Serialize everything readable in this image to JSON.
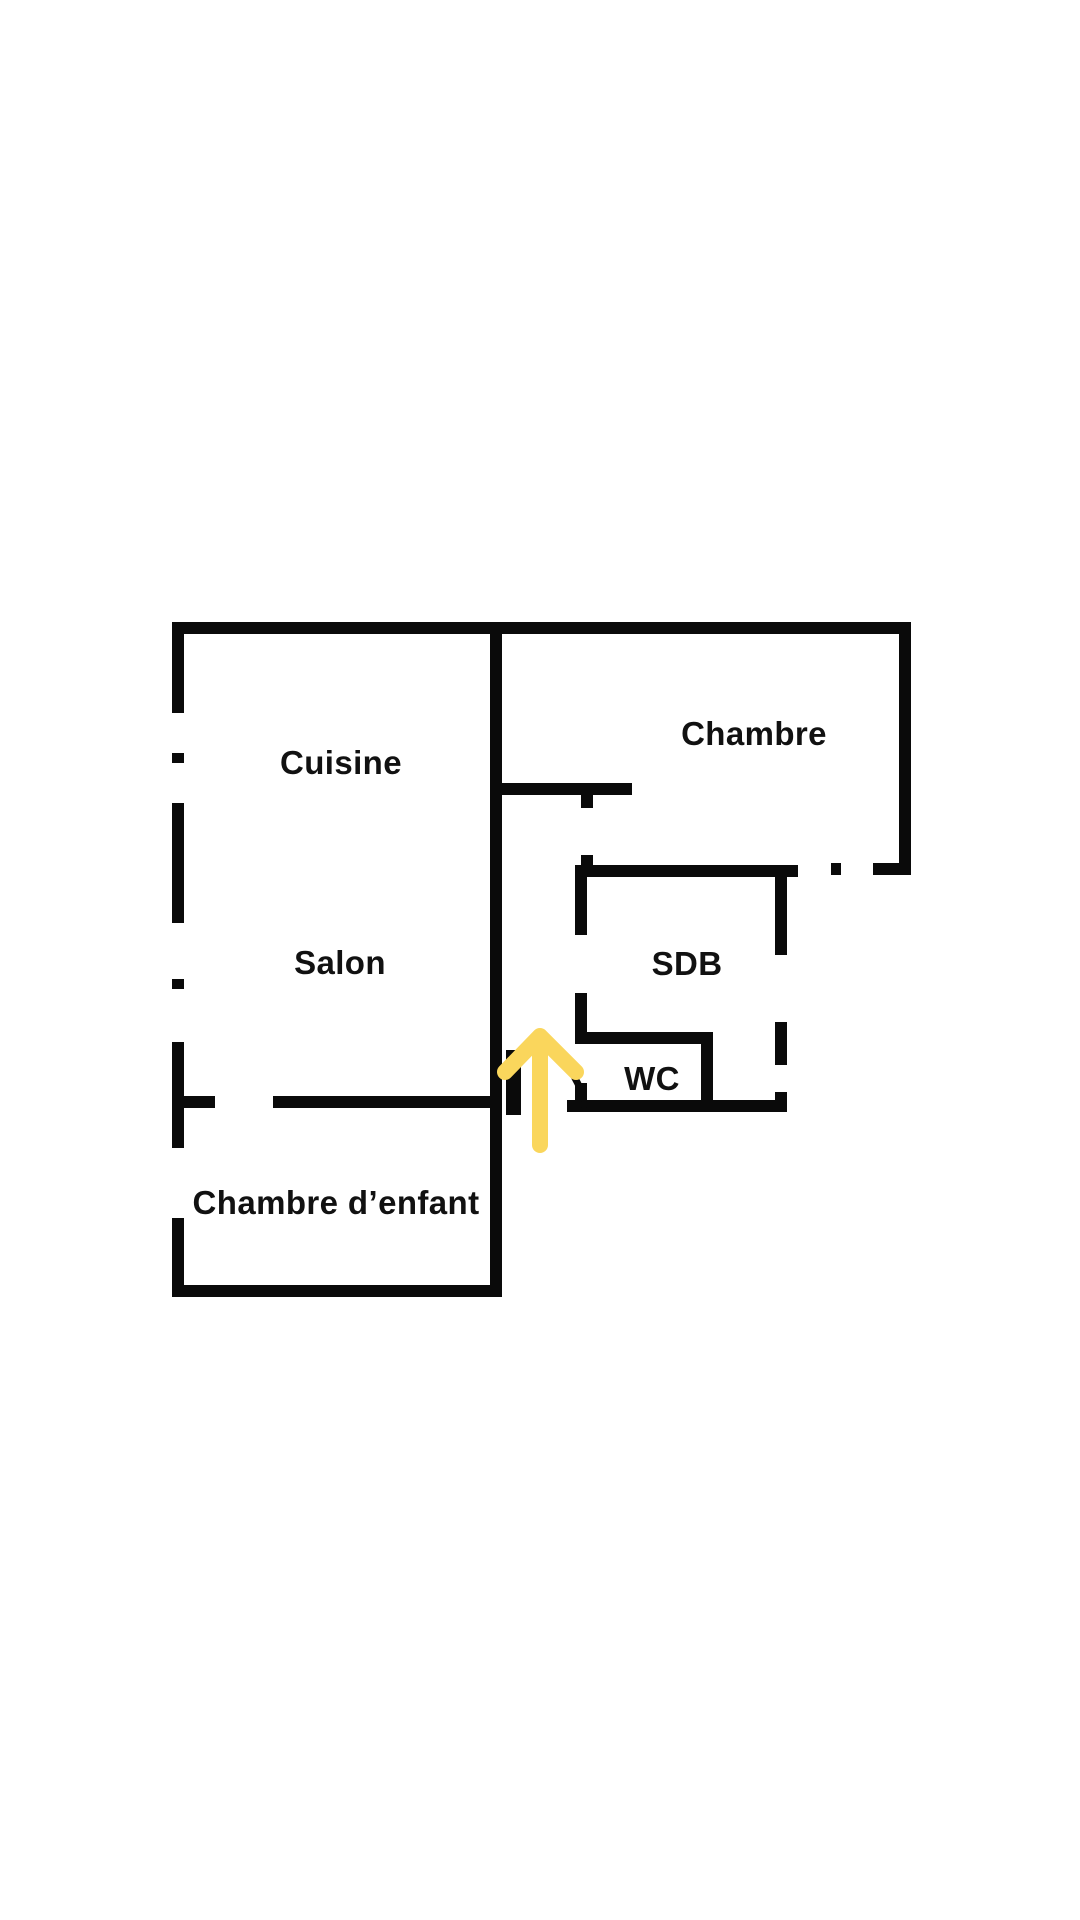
{
  "rooms": {
    "cuisine": {
      "label": "Cuisine"
    },
    "chambre": {
      "label": "Chambre"
    },
    "salon": {
      "label": "Salon"
    },
    "sdb": {
      "label": "SDB"
    },
    "wc": {
      "label": "WC"
    },
    "chambre_enfant": {
      "label": "Chambre d’enfant"
    }
  },
  "annotations": {
    "entrance_arrow_direction": "up"
  },
  "colors": {
    "wall": "#0a0a0a",
    "background": "#ffffff",
    "arrow": "#fad65c",
    "label_text": "#111111"
  }
}
